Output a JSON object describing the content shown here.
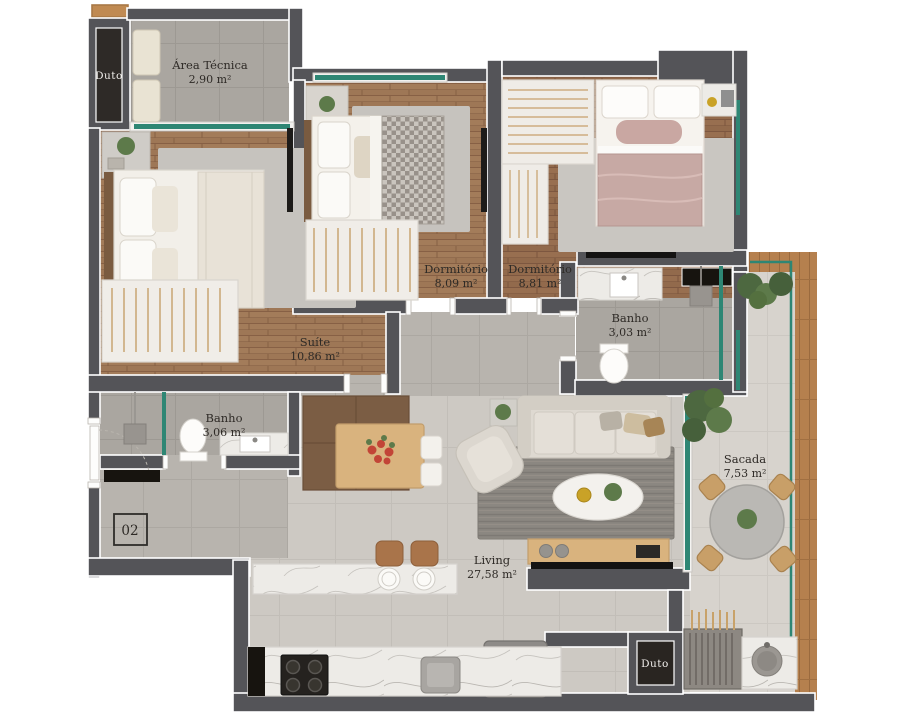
{
  "plan": {
    "unit_number": "02",
    "rooms": [
      {
        "id": "area-tecnica",
        "name": "Área Técnica",
        "area": "2,90 m²"
      },
      {
        "id": "dormitorio-1",
        "name": "Dormitório",
        "area": "8,09 m²"
      },
      {
        "id": "dormitorio-2",
        "name": "Dormitório",
        "area": "8,81 m²"
      },
      {
        "id": "suite",
        "name": "Suíte",
        "area": "10,86 m²"
      },
      {
        "id": "banho-1",
        "name": "Banho",
        "area": "3,03 m²"
      },
      {
        "id": "banho-2",
        "name": "Banho",
        "area": "3,06 m²"
      },
      {
        "id": "living",
        "name": "Living",
        "area": "27,58 m²"
      },
      {
        "id": "sacada",
        "name": "Sacada",
        "area": "7,53 m²"
      }
    ],
    "ducts": [
      {
        "id": "duct-top",
        "label": "Duto"
      },
      {
        "id": "duct-bottom",
        "label": "Duto"
      }
    ],
    "colors": {
      "wall": "#545458",
      "glass": "#2e8674",
      "wood_floor": "#9e7756",
      "wood_floor_dark": "#926a4c",
      "deck": "#b5804e",
      "tile_gray": "#aaa6a0",
      "living_floor": "#cdc9c3",
      "marble": "#edebe7",
      "accent_mauve": "#c7a9a4",
      "plant_green": "#5d7a4a"
    }
  }
}
